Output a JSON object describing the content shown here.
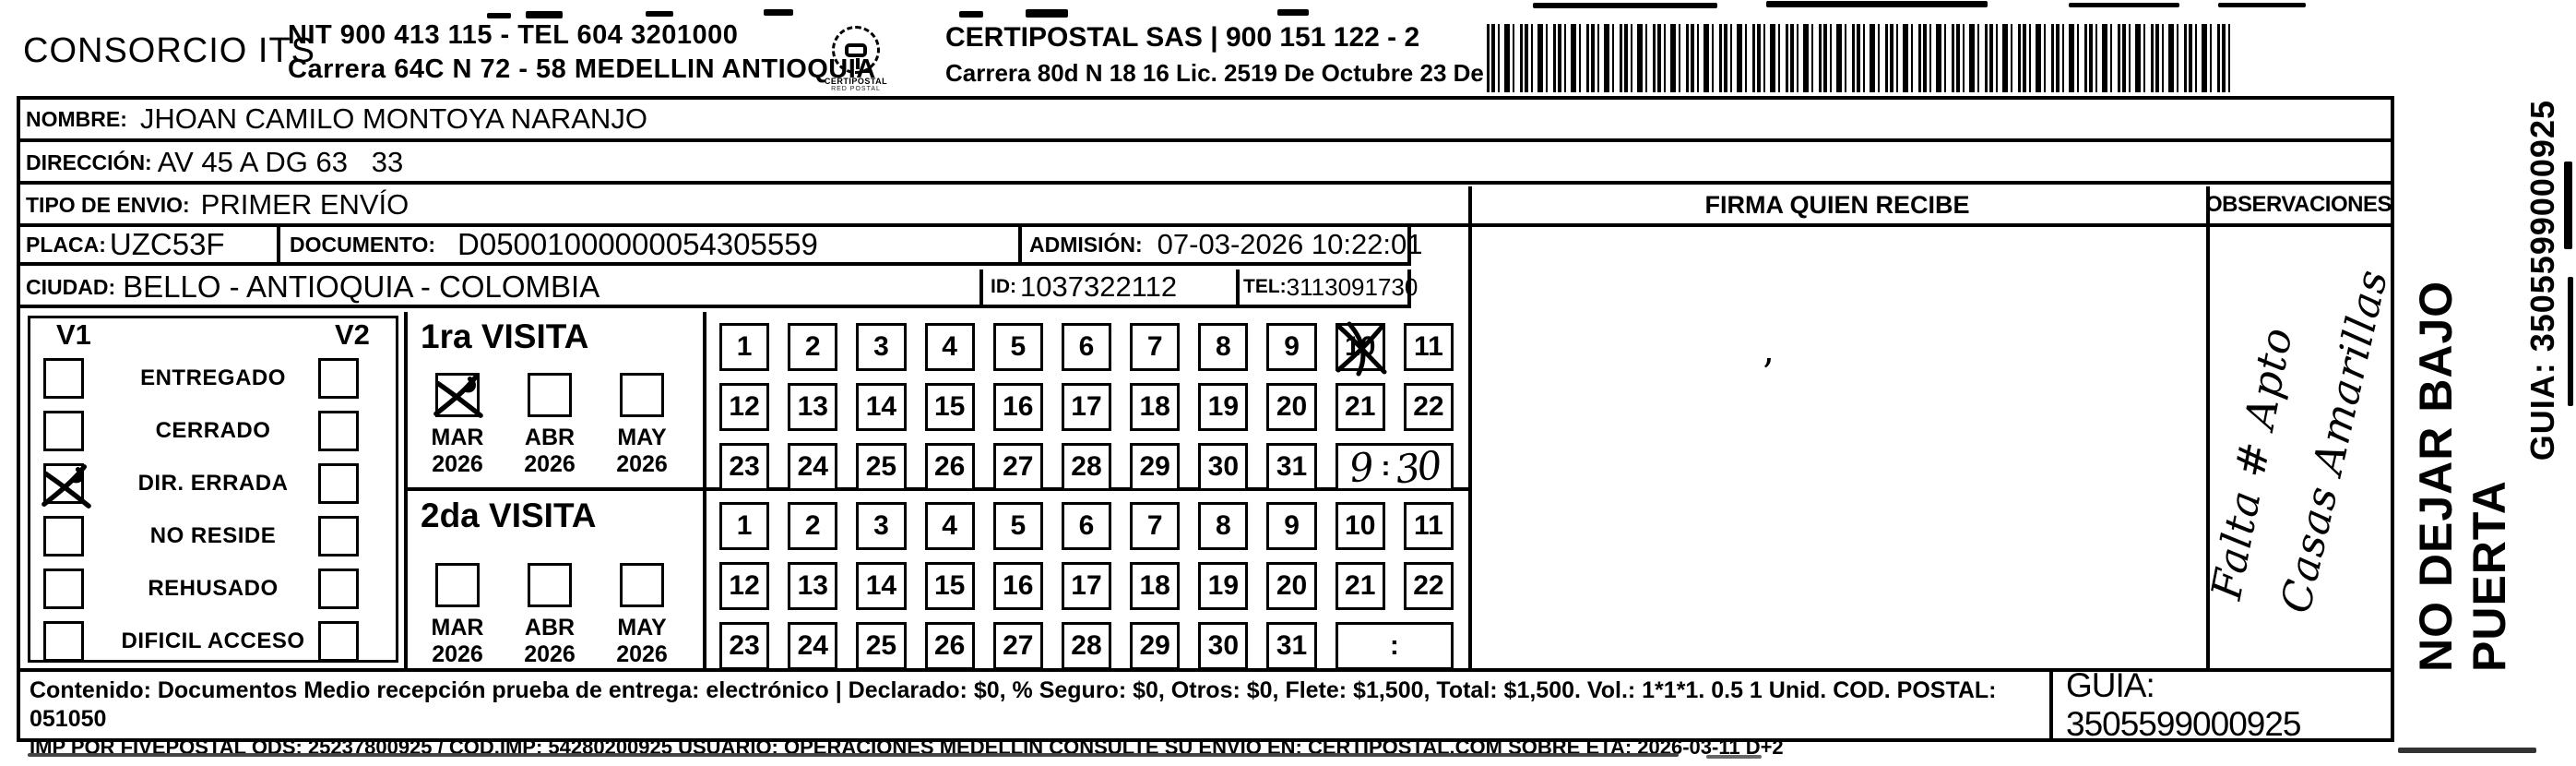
{
  "header": {
    "company_name": "CONSORCIO ITS",
    "company_nit_line": "NIT 900 413 115 - TEL 604 3201000",
    "company_address_line": "Carrera 64C N 72 - 58 MEDELLIN ANTIOQUIA",
    "logo_text": "CERTIPOSTAL",
    "logo_subtext": "RED POSTAL",
    "carrier_name_line": "CERTIPOSTAL SAS | 900 151 122 - 2",
    "carrier_address_line": "Carrera 80d N 18 16  Lic. 2519 De Octubre 23 De 2015"
  },
  "shipment": {
    "nombre_label": "NOMBRE:",
    "nombre_value": "JHOAN CAMILO MONTOYA NARANJO",
    "direccion_label": "DIRECCIÓN:",
    "direccion_value": "AV 45 A DG 63   33",
    "tipo_envio_label": "TIPO DE ENVIO:",
    "tipo_envio_value": "PRIMER ENVÍO",
    "placa_label": "PLACA:",
    "placa_value": "UZC53F",
    "documento_label": "DOCUMENTO:",
    "documento_value": "D05001000000054305559",
    "admision_label": "ADMISIÓN:",
    "admision_value": "07-03-2026 10:22:01",
    "ciudad_label": "CIUDAD:",
    "ciudad_value": "BELLO - ANTIOQUIA - COLOMBIA",
    "id_label": "ID:",
    "id_value": "1037322112",
    "tel_label": "TEL:",
    "tel_value": "3113091730"
  },
  "delivery_status": {
    "col1_label": "V1",
    "col2_label": "V2",
    "rows": [
      {
        "label": "ENTREGADO",
        "v1_checked": false,
        "v2_checked": false
      },
      {
        "label": "CERRADO",
        "v1_checked": false,
        "v2_checked": false
      },
      {
        "label": "DIR. ERRADA",
        "v1_checked": true,
        "v2_checked": false
      },
      {
        "label": "NO RESIDE",
        "v1_checked": false,
        "v2_checked": false
      },
      {
        "label": "REHUSADO",
        "v1_checked": false,
        "v2_checked": false
      },
      {
        "label": "DIFICIL ACCESO",
        "v1_checked": false,
        "v2_checked": false
      }
    ]
  },
  "visits": [
    {
      "title": "1ra VISITA",
      "months": [
        {
          "month": "MAR",
          "year": "2026",
          "checked": true
        },
        {
          "month": "ABR",
          "year": "2026",
          "checked": false
        },
        {
          "month": "MAY",
          "year": "2026",
          "checked": false
        }
      ],
      "day_rows": [
        [
          "1",
          "2",
          "3",
          "4",
          "5",
          "6",
          "7",
          "8",
          "9",
          "10",
          "11"
        ],
        [
          "12",
          "13",
          "14",
          "15",
          "16",
          "17",
          "18",
          "19",
          "20",
          "21",
          "22"
        ],
        [
          "23",
          "24",
          "25",
          "26",
          "27",
          "28",
          "29",
          "30",
          "31"
        ]
      ],
      "marked_day": "10",
      "time_value": "9:30"
    },
    {
      "title": "2da VISITA",
      "months": [
        {
          "month": "MAR",
          "year": "2026",
          "checked": false
        },
        {
          "month": "ABR",
          "year": "2026",
          "checked": false
        },
        {
          "month": "MAY",
          "year": "2026",
          "checked": false
        }
      ],
      "day_rows": [
        [
          "1",
          "2",
          "3",
          "4",
          "5",
          "6",
          "7",
          "8",
          "9",
          "10",
          "11"
        ],
        [
          "12",
          "13",
          "14",
          "15",
          "16",
          "17",
          "18",
          "19",
          "20",
          "21",
          "22"
        ],
        [
          "23",
          "24",
          "25",
          "26",
          "27",
          "28",
          "29",
          "30",
          "31"
        ]
      ],
      "marked_day": "",
      "time_value": ""
    }
  ],
  "firma": {
    "header": "FIRMA QUIEN RECIBE"
  },
  "observaciones": {
    "header": "OBSERVACIONES",
    "handwritten_line1": "Falta # Apto",
    "handwritten_line2": "Casas Amarillas"
  },
  "side_margin": {
    "no_dejar_text": "NO DEJAR BAJO PUERTA",
    "guia_text": "GUIA: 3505599000925"
  },
  "footer": {
    "content_line": "Contenido: Documentos Medio recepción prueba de entrega: electrónico | Declarado: $0, % Seguro: $0, Otros: $0, Flete: $1,500, Total: $1,500. Vol.: 1*1*1. 0.5  1 Unid. COD. POSTAL: 051050",
    "imp_line": "IMP POR FIVEPOSTAL ODS: 25237800925 / COD.IMP: 54280200925 USUARIO: OPERACIONES MEDELLIN CONSULTE SU ENVIO EN: CERTIPOSTAL.COM SOBRE ETA: 2026-03-11 D+2",
    "guia_value": "GUIA: 3505599000925"
  }
}
